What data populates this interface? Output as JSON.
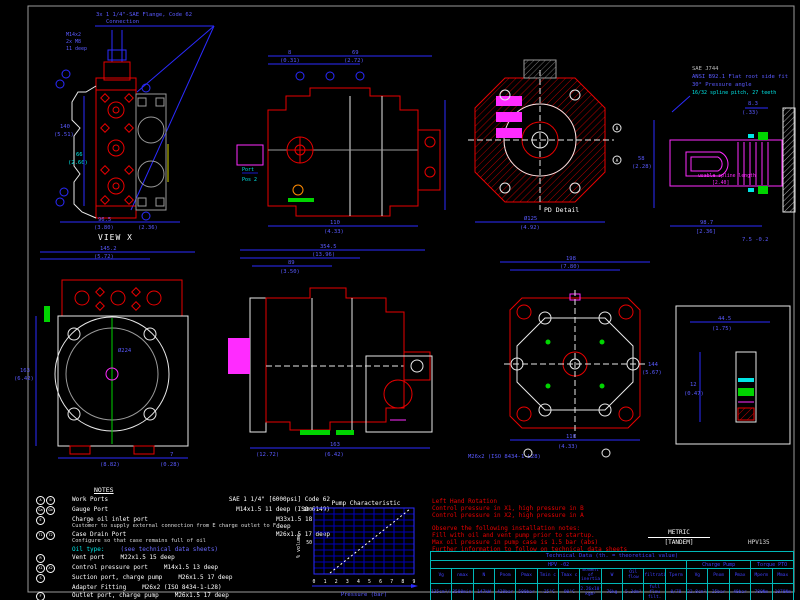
{
  "sheet": {
    "model": "HPV135",
    "units": "METRIC",
    "variant": "[TANDEM]"
  },
  "views": {
    "view_x": {
      "caption": "VIEW X",
      "flange_note": "3x 1 1/4\"-SAE Flange, Code 62",
      "flange_note2": "Connection",
      "thread_note1": "M14x2",
      "thread_note2": "2x M8",
      "thread_note3": "11 deep",
      "dims": [
        "96.5",
        "(3.80)",
        "66",
        "(2.60)",
        "140",
        "(5.51)",
        "(2.36)"
      ]
    },
    "front_view": {
      "label1": "Port",
      "label2": "Pos 2",
      "dims": [
        "8",
        "(0.31)",
        "69",
        "(2.72)",
        "110",
        "(4.33)"
      ]
    },
    "section_view": {
      "caption": "PD Detail",
      "letters": [
        "B",
        "A"
      ],
      "dims": [
        "Ø125",
        "(4.92)"
      ]
    },
    "shaft_detail": {
      "note1": "SAE J744",
      "note2": "ANSI B92.1 Flat root side fit",
      "note3": "30° Pressure angle",
      "note4": "16/32 spline pitch, 27 teeth",
      "spline_note": "usable spline length",
      "spline_dim": "[2.40]",
      "dims": [
        "8.3",
        "(.33)",
        "58",
        "(2.28)",
        "98.7",
        "[2.36]",
        "7.5 -0.2"
      ]
    },
    "flange_view": {
      "dims": [
        "145.2",
        "(5.72)",
        "163",
        "(6.42)",
        "Ø224",
        "(8.82)",
        "7",
        "(0.28)"
      ]
    },
    "side_view": {
      "dims": [
        "354.5",
        "(13.96)",
        "89",
        "(3.50)",
        "163",
        "(6.42)",
        "(12.72)"
      ]
    },
    "rear_view": {
      "fitting_note": "M26x2 (ISO 8434-1-L28)",
      "dims": [
        "198",
        "(7.80)",
        "110",
        "(4.33)",
        "144",
        "(5.67)"
      ]
    },
    "aux_view": {
      "dims": [
        "44.5",
        "(1.75)",
        "12",
        "(0.47)"
      ]
    }
  },
  "notes": {
    "title": "NOTES",
    "rows": [
      {
        "ports": [
          "A",
          "B"
        ],
        "label": "Work Ports",
        "sub": "",
        "spec": "SAE 1 1/4\" [6000psi]  Code 62",
        "align": "right",
        "cyan": false
      },
      {
        "ports": [
          "Ga",
          "Gb"
        ],
        "label": "Gauge Port",
        "sub": "",
        "spec": "M14x1.5   11 deep   (ISO 6149)",
        "align": "right",
        "cyan": false
      },
      {
        "ports": [
          "E"
        ],
        "label": "Charge oil inlet port",
        "sub": "Customer to supply external connection from  E  charge outlet to  F",
        "spec": "M33x1.5   18 deep",
        "align": "right",
        "cyan": false
      },
      {
        "ports": [
          "T1",
          "T2"
        ],
        "label": "Case Drain Port",
        "sub": "Configure so that case remains full of oil",
        "spec": "M26x1.5   17 deep",
        "align": "right",
        "cyan": false
      },
      {
        "ports": [],
        "label": "Oil type:",
        "sub": "",
        "spec": "(see technical data sheets)",
        "align": "m",
        "cyan": true
      },
      {
        "ports": [
          "R"
        ],
        "label": "Vent port",
        "sub": "",
        "spec": "M22x1.5   15 deep",
        "align": "m",
        "cyan": false
      },
      {
        "ports": [
          "X1",
          "X2"
        ],
        "label": "Control pressure port",
        "sub": "",
        "spec": "M14x1.5   13 deep",
        "align": "m",
        "cyan": false
      },
      {
        "ports": [
          "S"
        ],
        "label": "Suction port, charge pump",
        "sub": "",
        "spec": "M26x1.5   17 deep",
        "align": "m",
        "cyan": false
      },
      {
        "ports": [],
        "label": "Adapter Fitting",
        "sub": "",
        "spec": "M26x2 (ISO 8434-1-L28)",
        "align": "m",
        "cyan": false
      },
      {
        "ports": [
          "F"
        ],
        "label": "Outlet port, charge pump",
        "sub": "",
        "spec": "M26x1.5   17 deep",
        "align": "m",
        "cyan": false
      }
    ]
  },
  "chart": {
    "title": "Pump Characteristic",
    "xlabel": "Pressure (bar)",
    "ylabel": "% volume",
    "xticks": [
      "0",
      "1",
      "2",
      "3",
      "4",
      "5",
      "6",
      "7",
      "8",
      "9"
    ],
    "yticks": [
      "100",
      "50"
    ]
  },
  "chart_data": {
    "type": "line",
    "title": "Pump Characteristic",
    "xlabel": "Pressure (bar)",
    "ylabel": "% volume",
    "x": [
      2,
      9
    ],
    "y": [
      0,
      100
    ],
    "xlim": [
      0,
      9
    ],
    "ylim": [
      0,
      100
    ],
    "grid": true,
    "line_style": "dashed-white"
  },
  "install_notes": {
    "block1": [
      "Left Hand Rotation",
      "Control pressure in X1, high pressure in B",
      "Control pressure in X2, high pressure in A"
    ],
    "block2": [
      "Observe the following installation notes:",
      "Fill with oil and vent pump prior to startup.",
      "Max oil pressure in pump case is 1.5 bar (abs)",
      "Further information to follow on technical data sheets"
    ]
  },
  "tech_table": {
    "title": "Technical Data (th. = theoretical value)",
    "groups": [
      {
        "label": "HPV -02",
        "span": 12
      },
      {
        "label": "Charge Pump",
        "span": 3
      },
      {
        "label": "Torque PTO",
        "span": 2
      }
    ],
    "headers": [
      "Vg",
      "nmax",
      "N",
      "Pnom",
      "Pmax",
      "Tmin c",
      "Tmax c",
      "moment of inertia",
      "W",
      "Oil flow",
      "filtration",
      "Tperm",
      "Vg",
      "Pnom",
      "Pmax",
      "Mperm",
      "Mmax"
    ],
    "values": [
      "135cm³/r",
      "3500min⁻¹",
      "147kW",
      "420bar",
      "500bar",
      "-25°C",
      "90°C",
      "2.26x10⁻² kgm²",
      "76kg",
      "5.3dm³",
      "full flow filt.",
      "0/70",
      "22.8cm³/r",
      "25bar",
      "40bar",
      "780Nm",
      "1070Nm"
    ]
  },
  "colors": {
    "dim_blue": "#2b2bff",
    "part_red": "#e80000",
    "highlight_magenta": "#ff2bff",
    "seal_green": "#00d400",
    "accent_cyan": "#00e5e5",
    "note_red": "#e80000",
    "table_cyan": "#00b8b8",
    "text_white": "#ffffff"
  }
}
